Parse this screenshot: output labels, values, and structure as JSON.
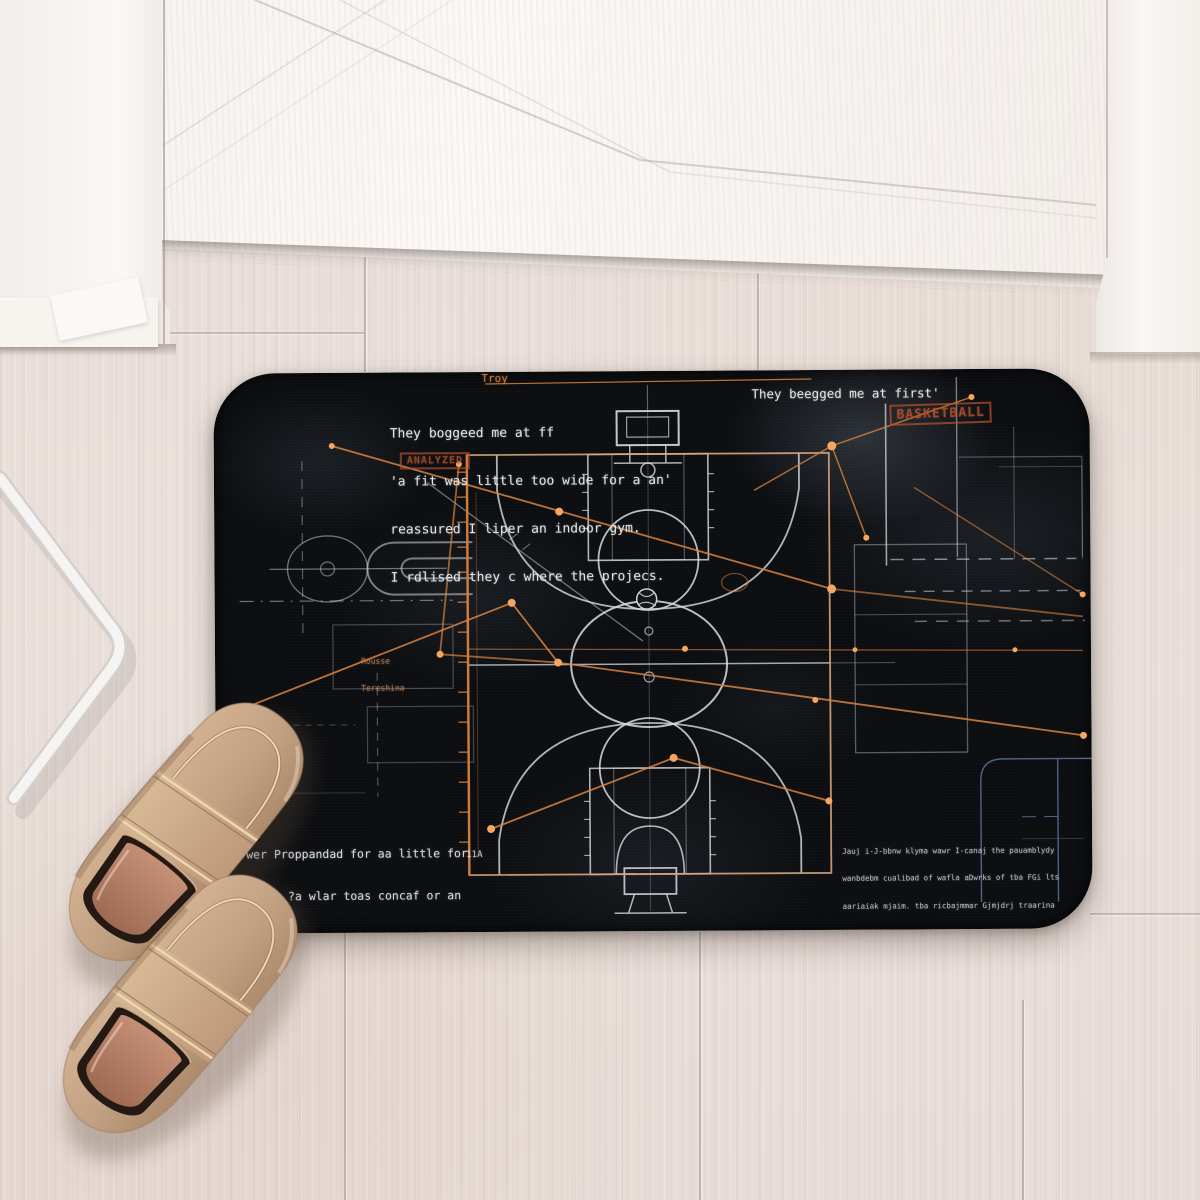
{
  "mat": {
    "bg_color": "#0c0e11",
    "chalk_color": "#d8dde0",
    "accent_orange": "#d9833f",
    "accent_blue": "#5f739b",
    "stamp_color": "#b5512e",
    "labels": {
      "troy": "Troy",
      "stamp_top_left": "ANALYZED",
      "stamp_top_right": "BASKETBALL",
      "tag_11a": "11A",
      "note_line1": "Rousse",
      "note_line2": "Tereshina"
    },
    "text_top_left": [
      "They boggeed me at ff",
      "'a fit was little too wide for a an'",
      "reassured I liper an indoor gym.",
      "I rdlised they c where the projecs."
    ],
    "text_top_right": "They beegged me at first'",
    "text_bottom_left": [
      "wer Proppandad for aa little for",
      "Traal ?a wlar toas concaf or an",
      "oof gofiu wigs. Rawriiu aofla ao",
      "iiatoaa gm, bat  indoor gym."
    ],
    "text_bottom_right": [
      "Jauj i-J-bbnw klyma wawr I-canaj the pauamblydy",
      "wanbdebm cualibad of wafla aDwrks of tba FGi lts",
      "aariaiak mjaim. tba ricbajmmar Gjmjdrj traarina",
      "brll w twtado ooaparbizy Ukl. wair jarljaia, ba h",
      "icalg bia frarla of naal canrlif crbbr kdrid aowir.",
      "bay brrt jrrr I'aniolat a w arrir nars ttm babtoda I",
      "jafcmantaj wttiart fanim af tba daf battbtay faahm."
    ]
  },
  "scene": {
    "floor_color": "#e8dfda",
    "door_color": "#f7f3f0",
    "rack_color": "#f5f3f0",
    "shoe_body_color": "#c2a183",
    "shoe_piping_color": "#ead2ac",
    "shoe_insole_color": "#b5806b"
  }
}
